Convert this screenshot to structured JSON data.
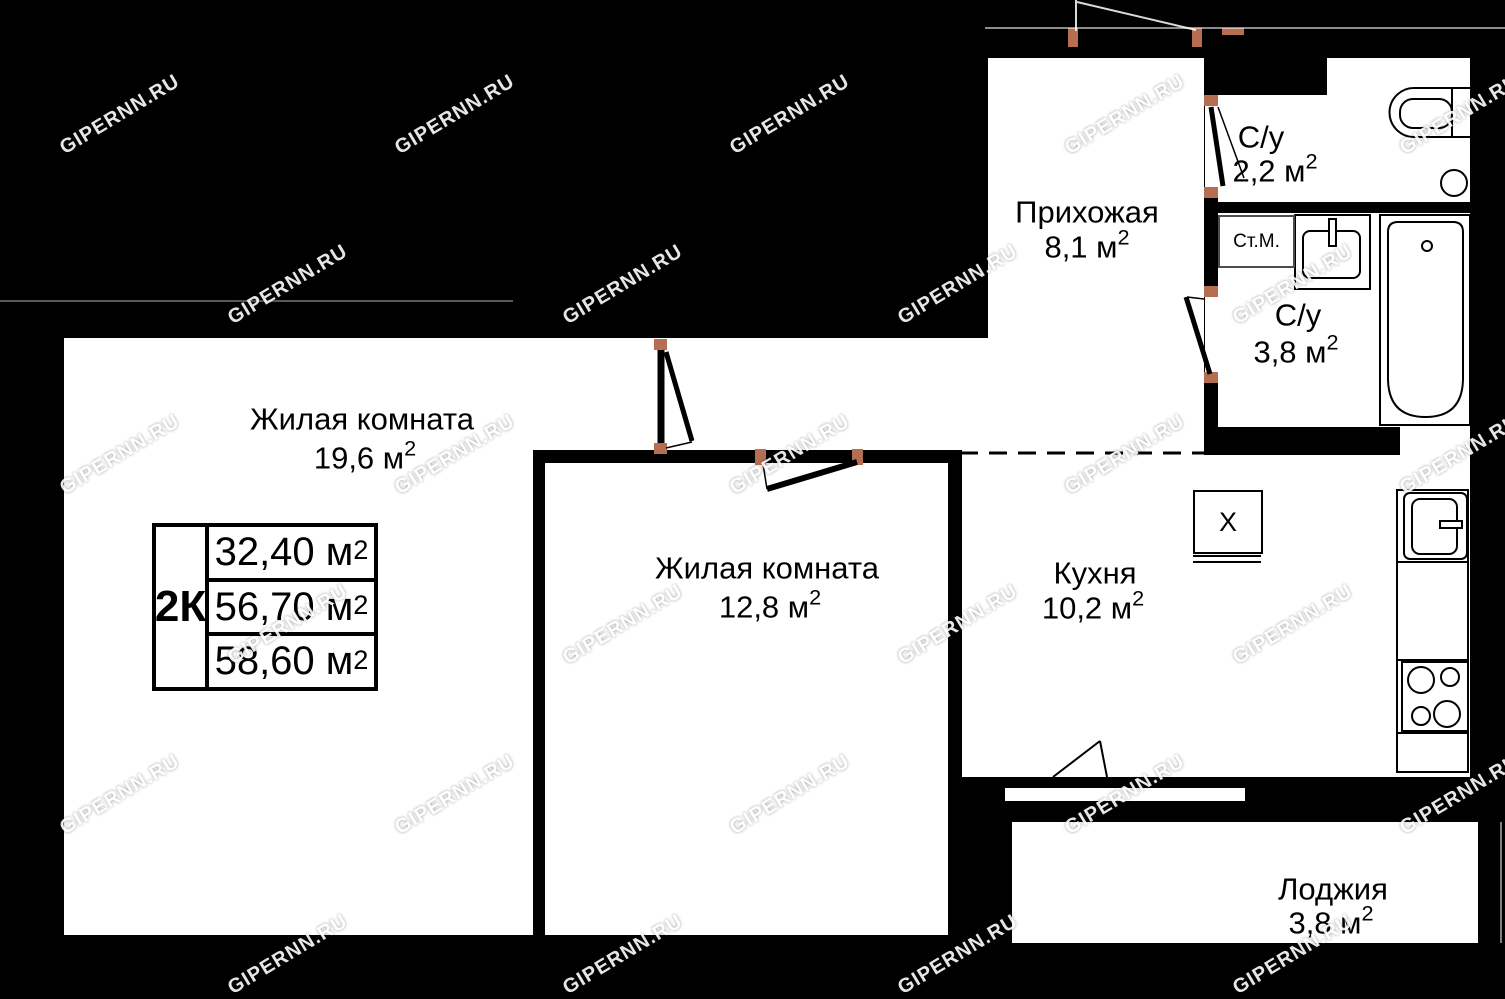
{
  "plan": {
    "watermark_text": "GIPERNN.RU",
    "legend": {
      "type_label": "2К",
      "rows": [
        {
          "value": "32,40 м",
          "sup": "2"
        },
        {
          "value": "56,70 м",
          "sup": "2"
        },
        {
          "value": "58,60 м",
          "sup": "2"
        }
      ]
    },
    "rooms": [
      {
        "name": "Жилая комната",
        "area": "19,6 м",
        "sup": "2"
      },
      {
        "name": "Жилая комната",
        "area": "12,8 м",
        "sup": "2"
      },
      {
        "name": "Прихожая",
        "area": "8,1 м",
        "sup": "2"
      },
      {
        "name": "Кухня",
        "area": "10,2 м",
        "sup": "2"
      },
      {
        "name": "С/у",
        "area": "2,2 м",
        "sup": "2"
      },
      {
        "name": "С/у",
        "area": "3,8 м",
        "sup": "2"
      },
      {
        "name": "Лоджия",
        "area": "3,8 м",
        "sup": "2"
      }
    ],
    "labels": {
      "washing_machine": "Ст.М.",
      "kitchen_counter": "X"
    }
  },
  "colors": {
    "wall": "#000000",
    "floor": "#ffffff",
    "door_jamb": "#b56e51",
    "watermark": "#ffffff",
    "washing_machine_border": "#4d4d4d"
  }
}
